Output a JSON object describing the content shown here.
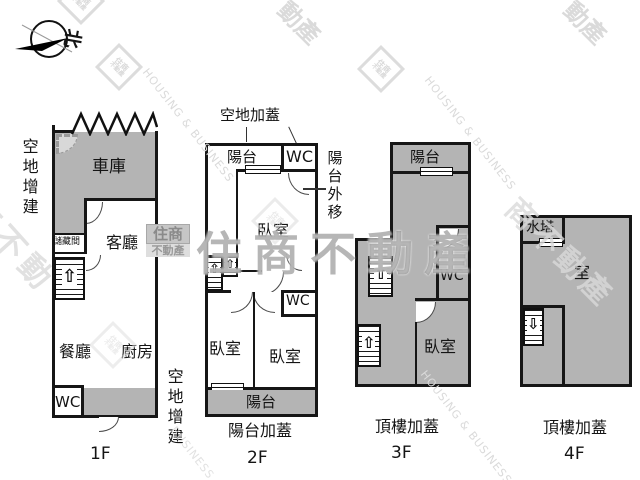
{
  "compass": {
    "north": "北"
  },
  "icons": {
    "stair_up": "⇧",
    "stair_down": "⇩"
  },
  "floor1": {
    "name": "1F",
    "note_left": "空地增建",
    "note_right": "空地增建",
    "garage": "車庫",
    "living": "客廳",
    "storage": "儲藏間",
    "dining": "餐廳",
    "kitchen": "廚房",
    "wc": "WC"
  },
  "floor2": {
    "name": "2F",
    "note_top": "空地加蓋",
    "note_right": "陽台外移",
    "note_bottom": "陽台加蓋",
    "balcony_top": "陽台",
    "wc_top": "WC",
    "bedroom_top": "臥室",
    "wc_mid": "WC",
    "bedroom_left": "臥室",
    "bedroom_right": "臥室",
    "balcony_bottom": "陽台"
  },
  "floor3": {
    "name": "3F",
    "note_bottom": "頂樓加蓋",
    "balcony": "陽台",
    "wc": "WC",
    "bedroom": "臥室"
  },
  "floor4": {
    "name": "4F",
    "note_bottom": "頂樓加蓋",
    "water_tank": "水塔",
    "room": "室"
  },
  "watermark": {
    "brand": "住商不動產",
    "logo_top": "住商",
    "logo_bottom": "不動產",
    "housing": "HOUSING & BUSINESS",
    "frag_dongchan": "動產",
    "frag_left": "商不動",
    "frag_right": "商不動產",
    "frag_business": "BUSINESS"
  }
}
